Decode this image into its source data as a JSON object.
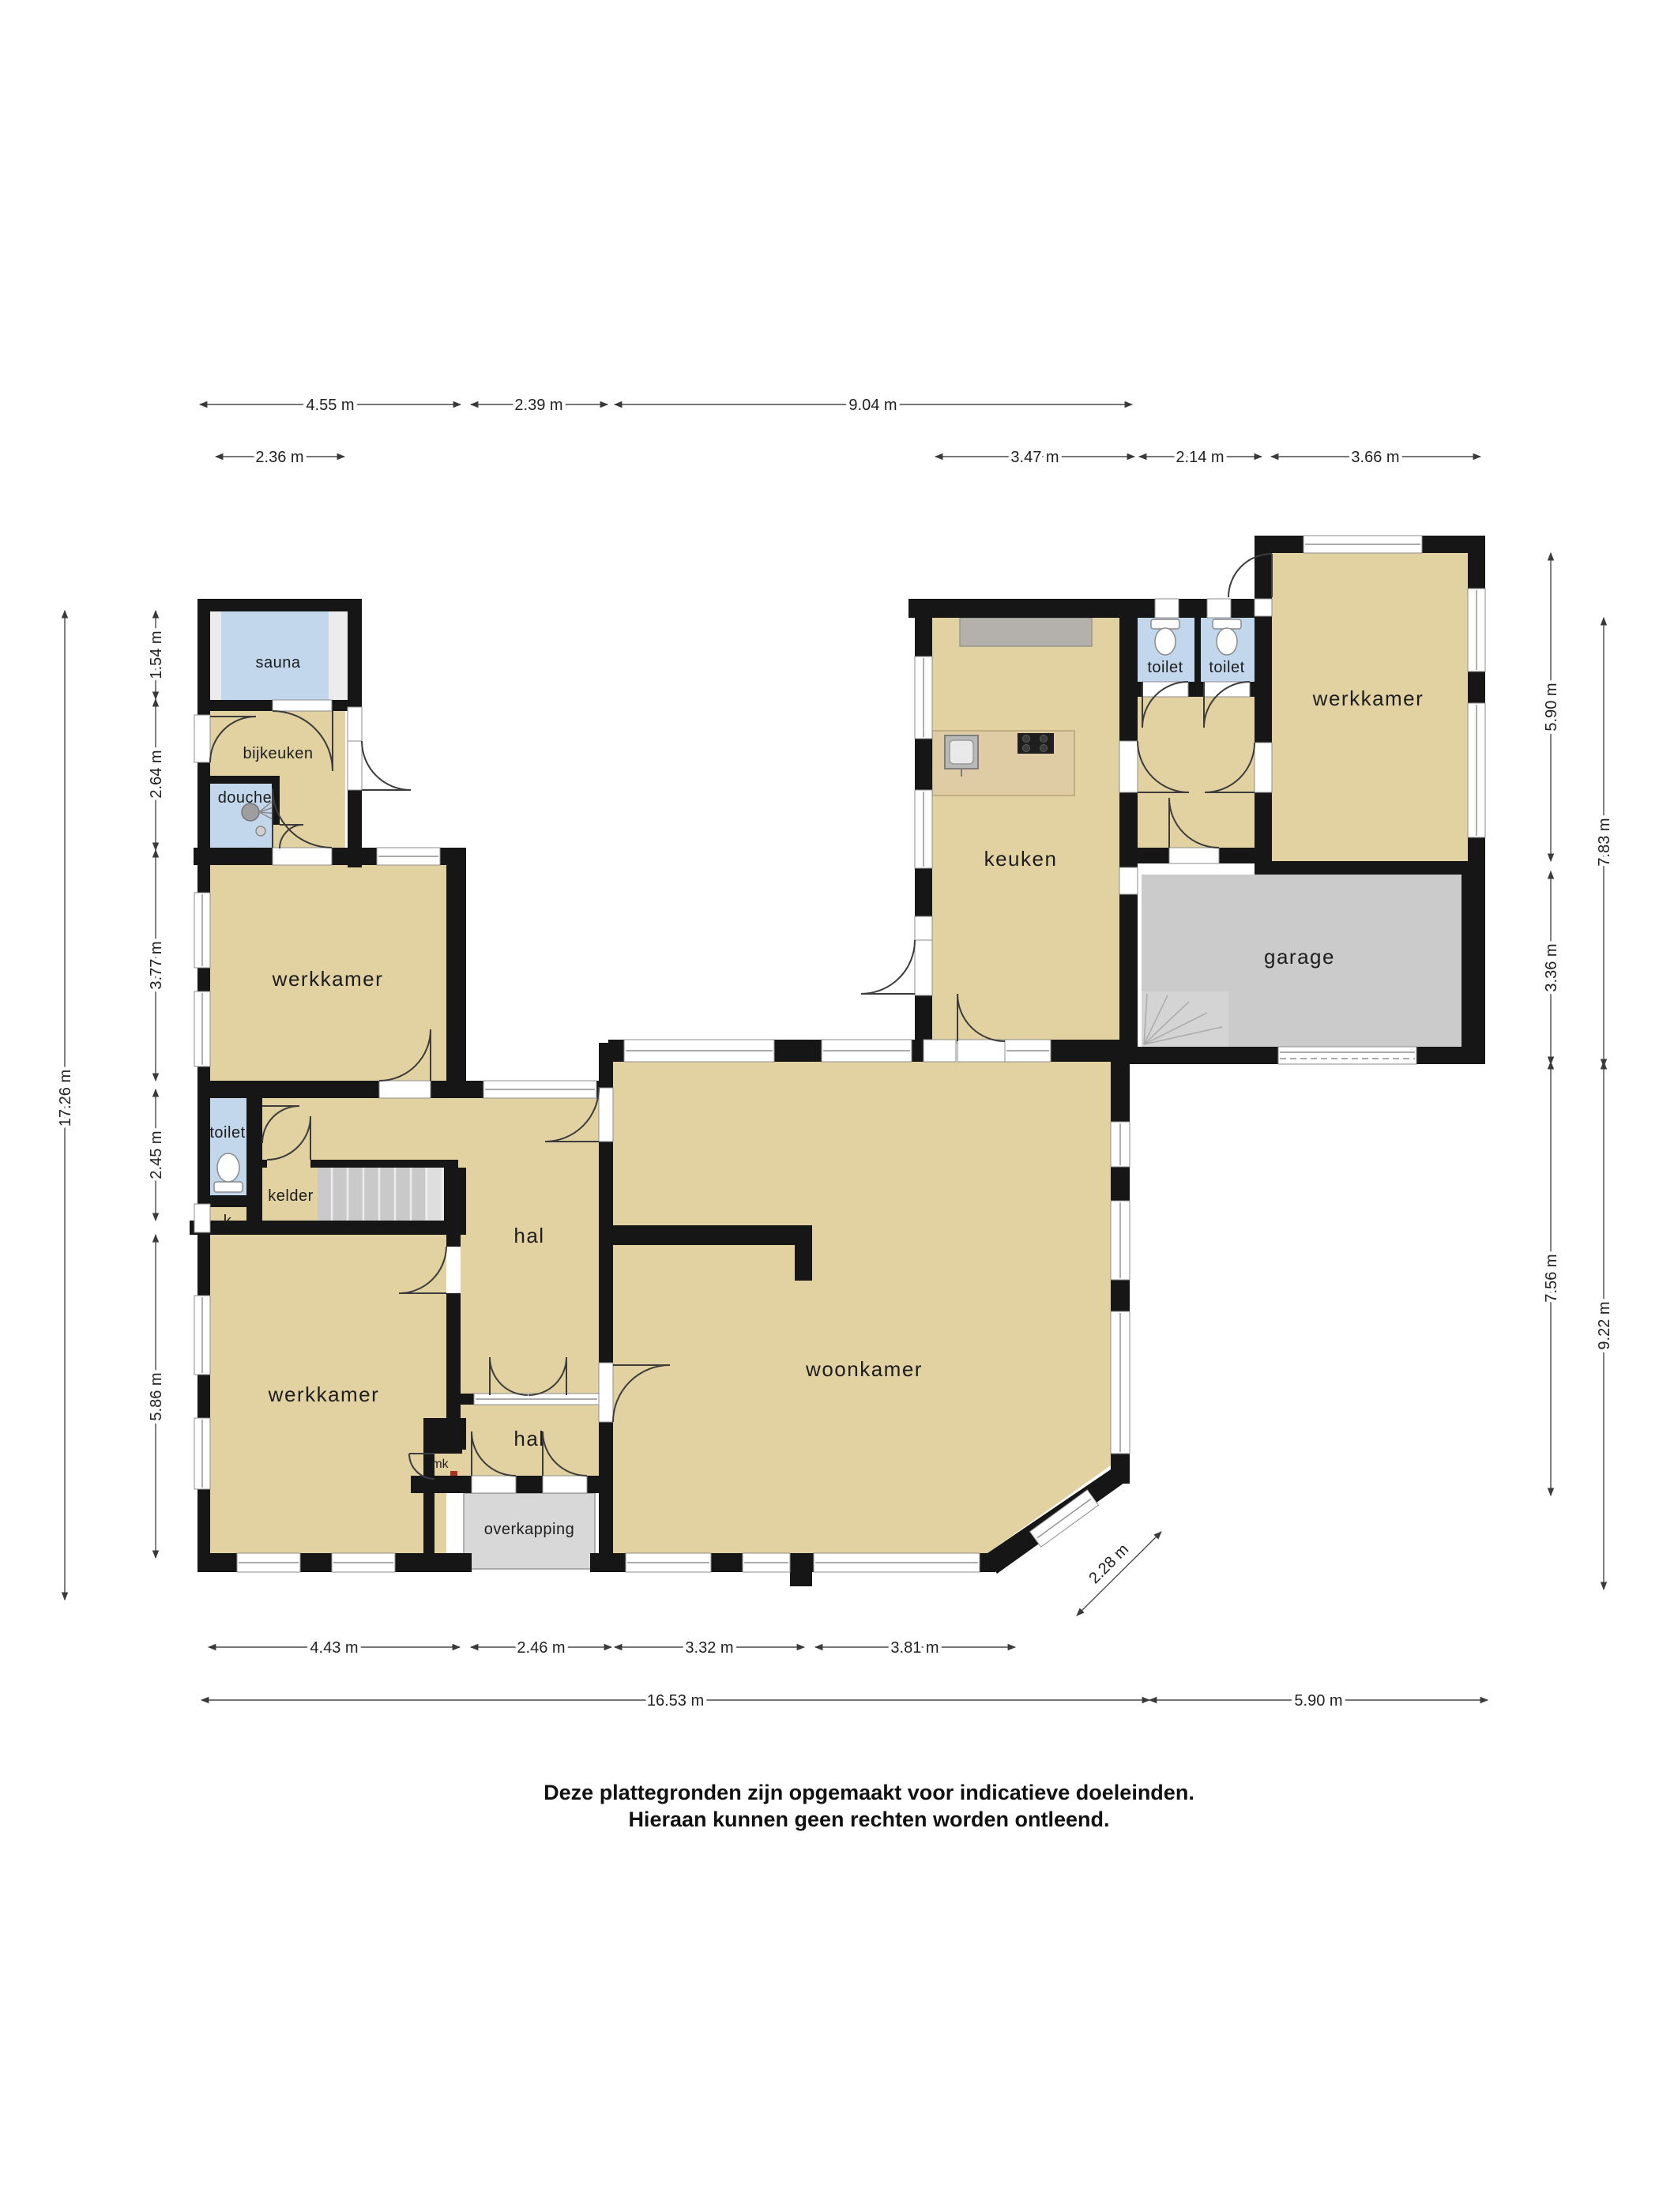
{
  "type": "floor-plan",
  "rooms": {
    "sauna": "sauna",
    "bijkeuken": "bijkeuken",
    "douche": "douche",
    "werkkamer_linksboven": "werkkamer",
    "toilet_links": "toilet",
    "kelder": "kelder",
    "kast": "k",
    "werkkamer_linksonder": "werkkamer",
    "hal_boven": "hal",
    "hal_onder": "hal",
    "meterkast": "mk",
    "overkapping": "overkapping",
    "woonkamer": "woonkamer",
    "keuken": "keuken",
    "toilet_1": "toilet",
    "toilet_2": "toilet",
    "werkkamer_rechtsboven": "werkkamer",
    "garage": "garage"
  },
  "dimensions": {
    "top_row1": [
      "4.55 m",
      "2.39 m",
      "9.04 m"
    ],
    "top_row2": [
      "2.36 m"
    ],
    "top_row2_right": [
      "3.47 m",
      "2.14 m",
      "3.66 m"
    ],
    "left_inner": [
      "1.54 m",
      "2.64 m",
      "3.77 m",
      "2.45 m",
      "5.86 m"
    ],
    "left_outer": "17.26 m",
    "right_inner": [
      "5.90 m",
      "3.36 m",
      "7.56 m"
    ],
    "right_outer": [
      "7.83 m",
      "9.22 m"
    ],
    "bottom_row1": [
      "4.43 m",
      "2.46 m",
      "3.32 m",
      "3.81 m"
    ],
    "bottom_diagonal": "2.28 m",
    "bottom_row2": [
      "16.53 m",
      "5.90 m"
    ]
  },
  "footer": {
    "line1": "Deze plattegronden zijn opgemaakt voor indicatieve doeleinden.",
    "line2": "Hieraan kunnen geen rechten worden ontleend."
  },
  "colors": {
    "room_fill": "#e2d2a2",
    "wet_room_fill": "#c2d7eb",
    "garage_fill": "#cbcbcb",
    "overkapping_fill": "#d8d8d8",
    "wall": "#161616",
    "counter": "#b4b1ac",
    "island_wood": "#e0cca4"
  }
}
